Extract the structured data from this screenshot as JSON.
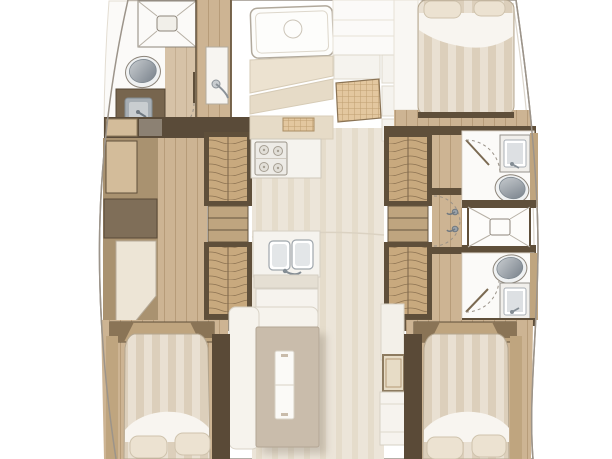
{
  "image": {
    "kind": "yacht-interior-floor-plan",
    "view": "top-down",
    "orientation": "bow-up"
  },
  "rooms": [
    {
      "name": "forward-head",
      "fixtures": [
        "shower",
        "toilet",
        "sink-vanity",
        "door"
      ]
    },
    {
      "name": "galley",
      "fixtures": [
        "overhead-hatch",
        "cabinetry",
        "rattan-panel",
        "stove-cooktop",
        "double-sink",
        "counter"
      ]
    },
    {
      "name": "forward-starboard-cabin",
      "fixtures": [
        "double-bed",
        "pillows",
        "wardrobe",
        "door"
      ]
    },
    {
      "name": "port-corridor",
      "fixtures": [
        "louver-locker",
        "shelf-unit",
        "louver-locker",
        "cabinets"
      ]
    },
    {
      "name": "starboard-corridor",
      "fixtures": [
        "louver-locker",
        "shelf-unit",
        "louver-locker",
        "doors"
      ]
    },
    {
      "name": "starboard-forward-head",
      "fixtures": [
        "sink-vanity",
        "toilet",
        "door"
      ]
    },
    {
      "name": "shared-shower",
      "fixtures": [
        "shower"
      ]
    },
    {
      "name": "starboard-aft-head",
      "fixtures": [
        "toilet",
        "sink-vanity",
        "door"
      ]
    },
    {
      "name": "salon",
      "fixtures": [
        "bench-seat",
        "dining-table",
        "table-runner",
        "cabinet",
        "framed-panel"
      ]
    },
    {
      "name": "port-aft-cabin",
      "fixtures": [
        "double-bed",
        "pillows",
        "headboard"
      ]
    },
    {
      "name": "starboard-aft-cabin",
      "fixtures": [
        "double-bed",
        "pillows",
        "headboard"
      ]
    }
  ],
  "colors": {
    "hull-line": "#9c948a",
    "hull-inner": "#dcd6cc",
    "wood-floor": "#cdb493",
    "wood-line": "#b79c79",
    "wood-light": "#d3bc9a",
    "wood-mid": "#bfa57f",
    "wood-dark": "#5f4f3a",
    "wood-post": "#5a4a37",
    "wood-wedge": "#8a7456",
    "wood-cab-dark": "#7f6e58",
    "band-dark": "#5a4b39",
    "dark-cabinet": "#77654e",
    "louver": "#c8a97e",
    "louver-line": "#8d7352",
    "rattan": "#e3c79f",
    "rattan-line": "#bf9f72",
    "floor-pale": "#ece5d9",
    "floor-pale-2": "#e5dccb",
    "room-white": "#fbfaf8",
    "counter": "#f5f3ee",
    "counter-line": "#d5cfc3",
    "panel-beige": "#ece2d0",
    "panel-beige-2": "#e6dbc7",
    "panel-cream": "#ede5d6",
    "fixture-outline": "#8d857a",
    "steel": "#a7aeb4",
    "steel-light": "#c9cdd0",
    "steel-dark": "#77808a",
    "duvet-a": "#e9e0d2",
    "duvet-b": "#dccfbb",
    "sheet": "#f8f5f0",
    "pillow": "#ece2d1",
    "pillow-line": "#cfc3ad",
    "table": "#c9bcab",
    "table-line": "#b3a694",
    "shadow": "#8a7f70",
    "arc": "#9a9288"
  }
}
